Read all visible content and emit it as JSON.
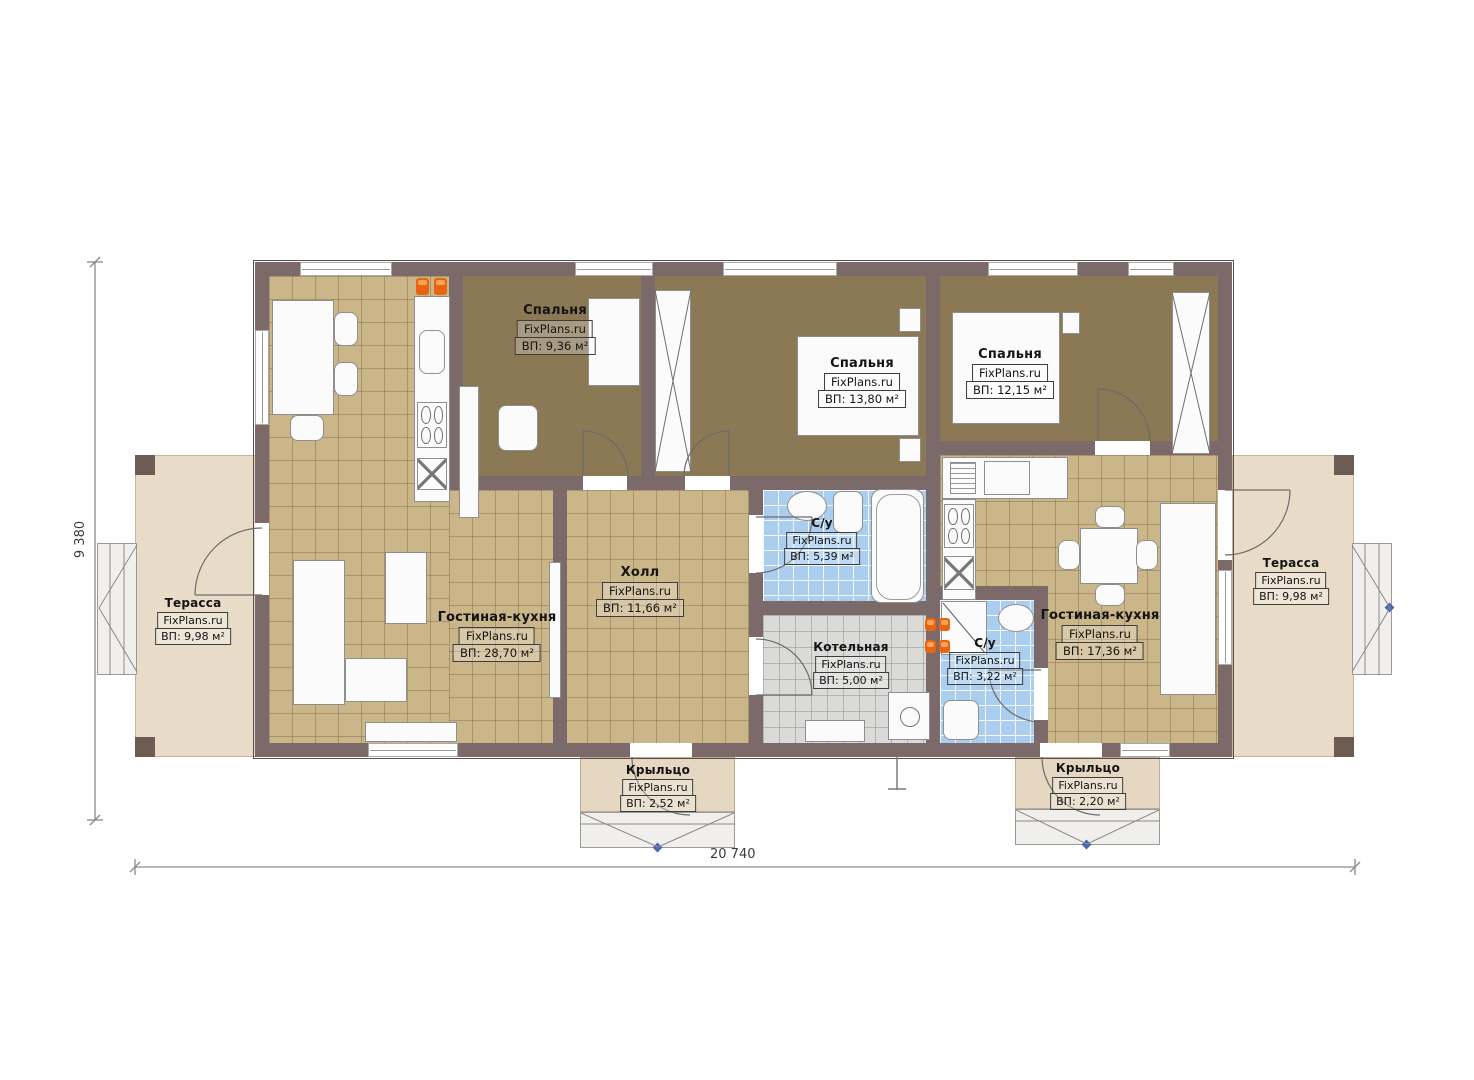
{
  "watermark": "FixPlans.ru",
  "rooms": [
    {
      "id": "bedroom-1",
      "name": "Спальня",
      "watermark": "FixPlans.ru",
      "area": "ВП: 9,36 м²"
    },
    {
      "id": "bedroom-2",
      "name": "Спальня",
      "watermark": "FixPlans.ru",
      "area": "ВП: 13,80 м²"
    },
    {
      "id": "bedroom-3",
      "name": "Спальня",
      "watermark": "FixPlans.ru",
      "area": "ВП: 12,15 м²"
    },
    {
      "id": "hall",
      "name": "Холл",
      "watermark": "FixPlans.ru",
      "area": "ВП: 11,66 м²"
    },
    {
      "id": "living-kitchen-left",
      "name": "Гостиная-кухня",
      "watermark": "FixPlans.ru",
      "area": "ВП: 28,70 м²"
    },
    {
      "id": "bathroom-1",
      "name": "С/у",
      "watermark": "FixPlans.ru",
      "area": "ВП: 5,39 м²"
    },
    {
      "id": "boiler-room",
      "name": "Котельная",
      "watermark": "FixPlans.ru",
      "area": "ВП: 5,00 м²"
    },
    {
      "id": "bathroom-2",
      "name": "С/у",
      "watermark": "FixPlans.ru",
      "area": "ВП: 3,22 м²"
    },
    {
      "id": "living-kitchen-right",
      "name": "Гостиная-кухня",
      "watermark": "FixPlans.ru",
      "area": "ВП: 17,36 м²"
    },
    {
      "id": "terrace-left",
      "name": "Терасса",
      "watermark": "FixPlans.ru",
      "area": "ВП: 9,98 м²"
    },
    {
      "id": "terrace-right",
      "name": "Терасса",
      "watermark": "FixPlans.ru",
      "area": "ВП: 9,98 м²"
    },
    {
      "id": "porch-left",
      "name": "Крыльцо",
      "watermark": "FixPlans.ru",
      "area": "ВП: 2,52 м²"
    },
    {
      "id": "porch-right",
      "name": "Крыльцо",
      "watermark": "FixPlans.ru",
      "area": "ВП: 2,20 м²"
    }
  ],
  "dimensions": {
    "overall_width": "20 740",
    "overall_height": "9 380"
  },
  "colors": {
    "wall": "#7c6a6a",
    "tile_tan": "#cbb68a",
    "carpet_brown": "#8b7956",
    "tile_blue": "#abceef",
    "tile_gray": "#dadad8",
    "terrace": "#e8dcc8",
    "porch": "#e5d7c1",
    "accent_orange": "#e8640f",
    "marker_blue": "#4a66b0"
  }
}
